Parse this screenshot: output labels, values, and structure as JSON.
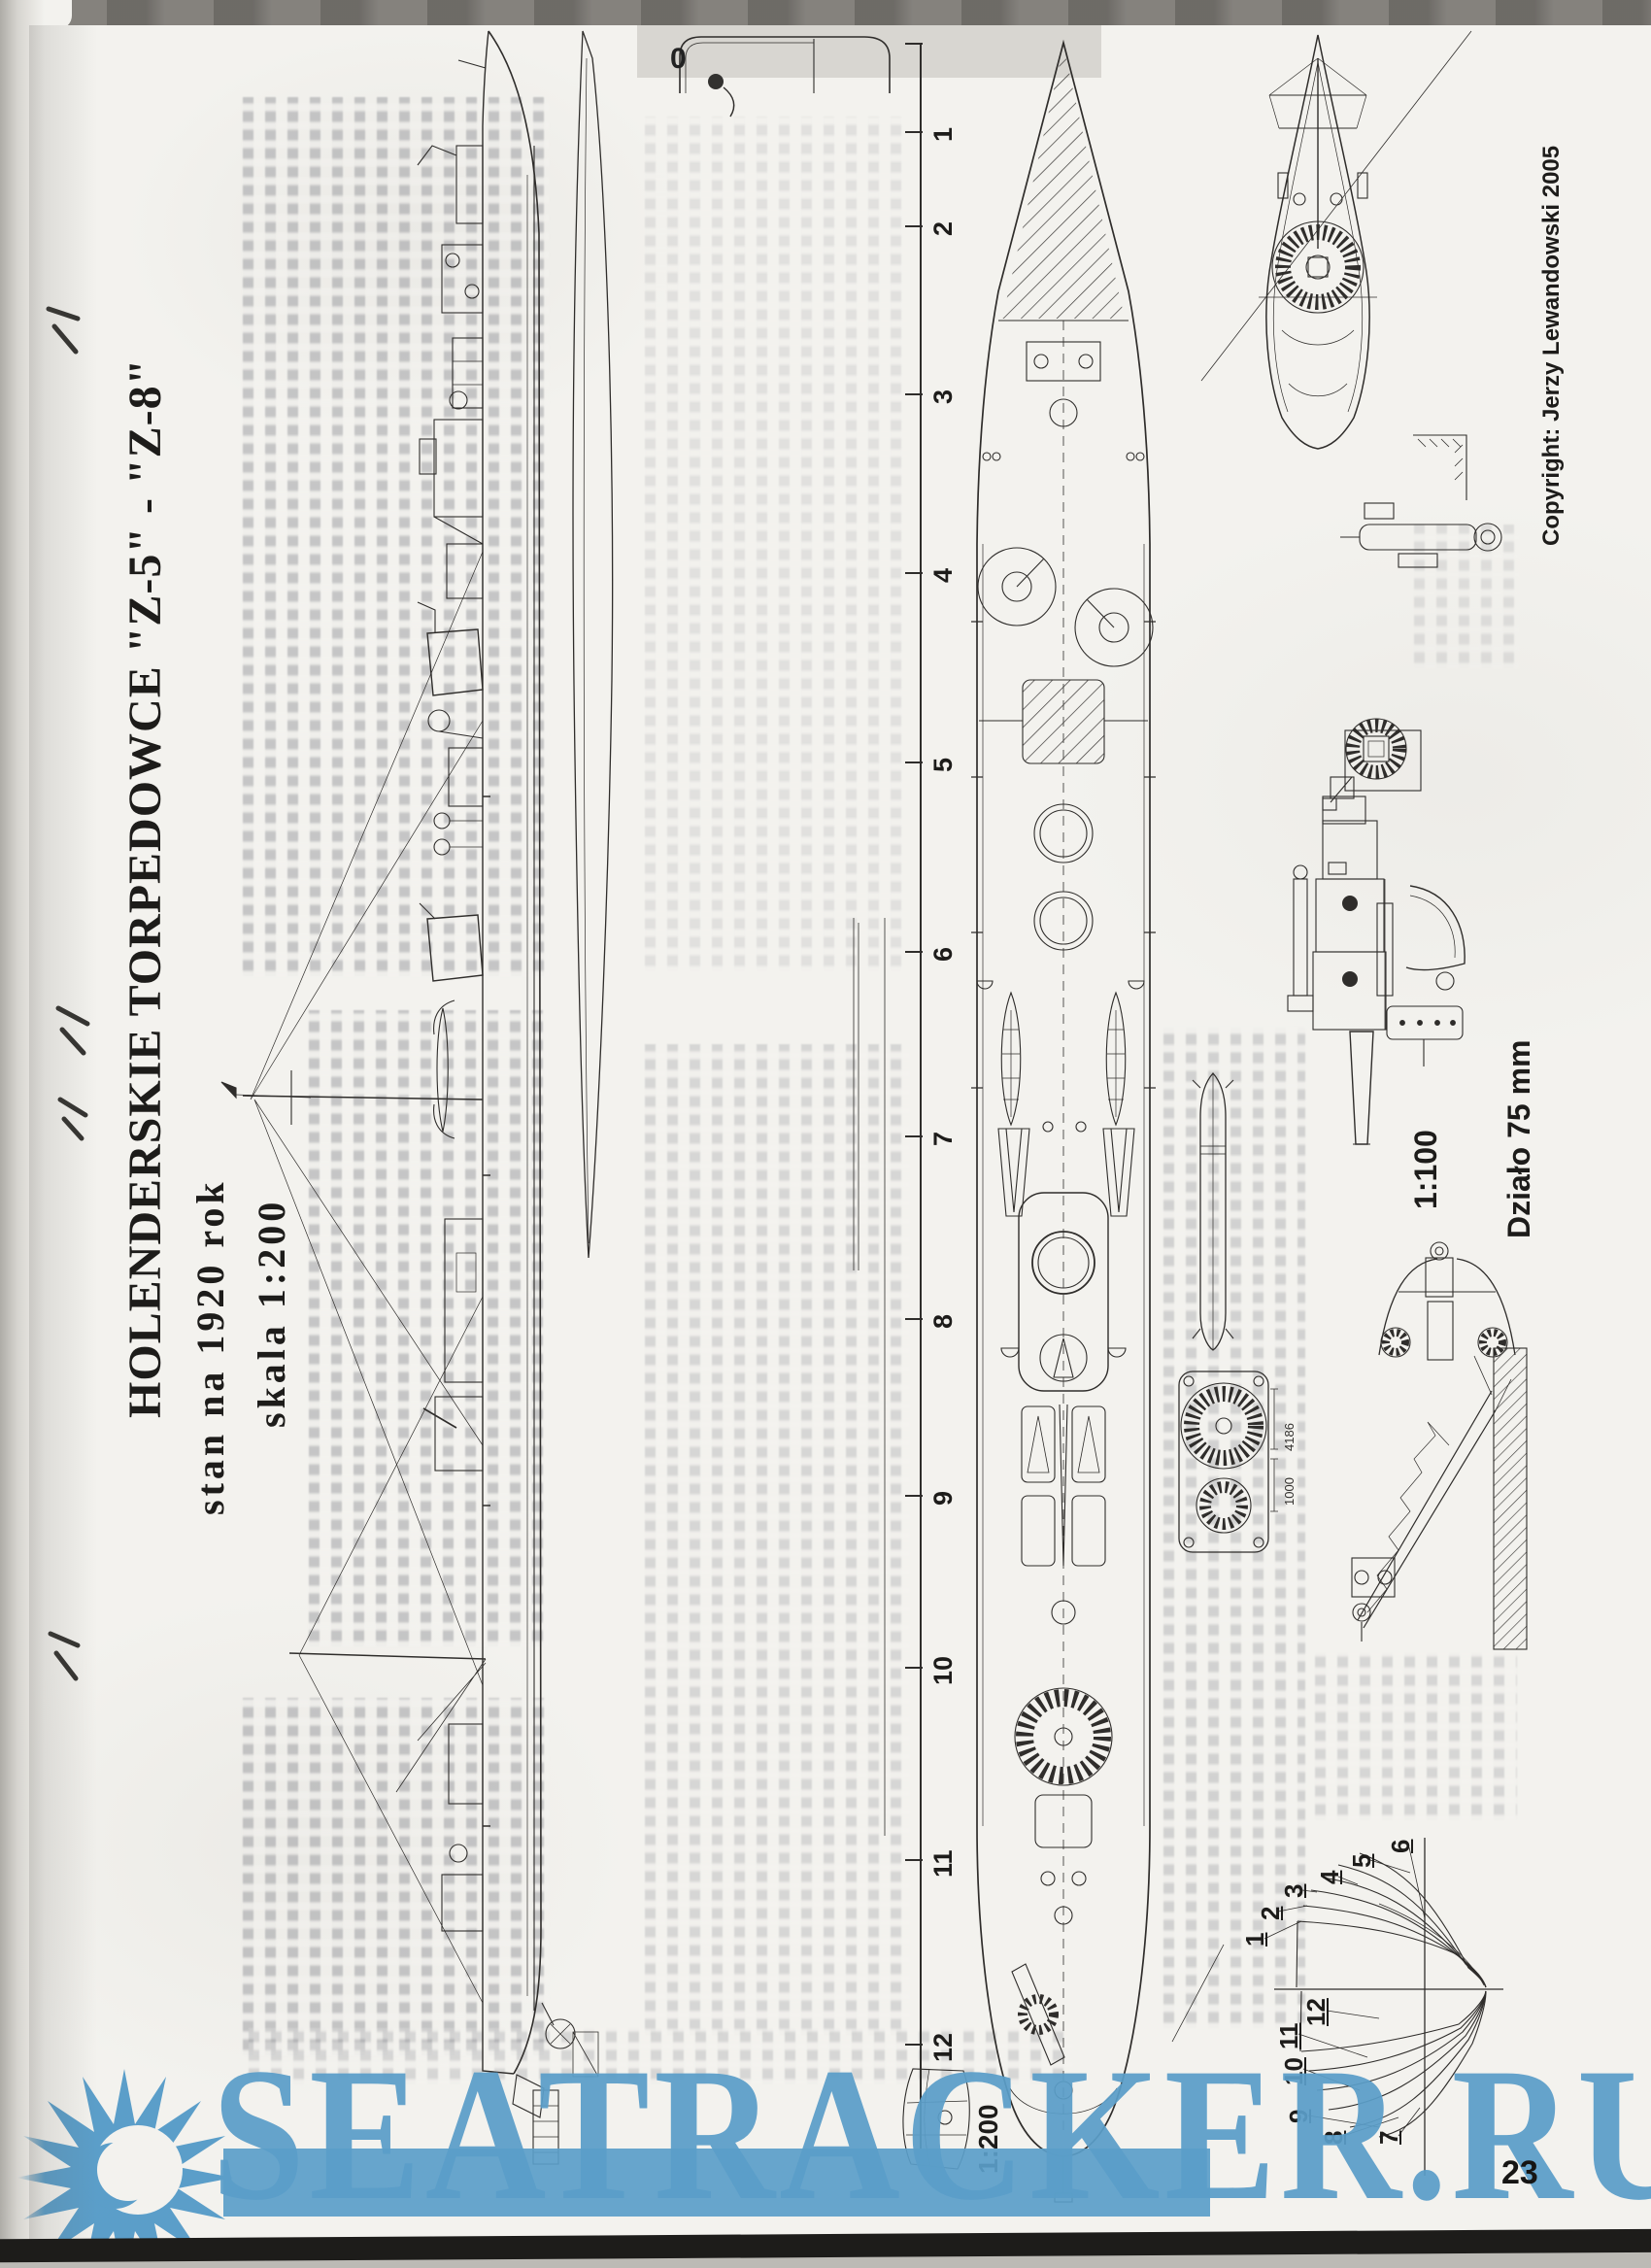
{
  "header": {
    "title": "HOLENDERSKIE TORPEDOWCE \"Z-5\" - \"Z-8\"",
    "subtitle": "stan na 1920 rok",
    "scale_note": "skala 1:200"
  },
  "copyright": "Copyright: Jerzy Lewandowski 2005",
  "gun": {
    "scale": "1:100",
    "name": "Działo 75 mm"
  },
  "ruler": {
    "scale_label": "1:200",
    "ticks": [
      "1",
      "2",
      "3",
      "4",
      "5",
      "6",
      "7",
      "8",
      "9",
      "10",
      "11",
      "12"
    ]
  },
  "plan_marker": "0",
  "dimensions": {
    "d1": "4186",
    "d2": "1000"
  },
  "body_plan": {
    "frames": [
      "1",
      "2",
      "3",
      "4",
      "5",
      "6",
      "7",
      "8",
      "9",
      "10",
      "11",
      "12"
    ]
  },
  "watermark": {
    "text": "SEATRACKER.RU",
    "color": "#5b9ec9"
  },
  "page_number": "23"
}
